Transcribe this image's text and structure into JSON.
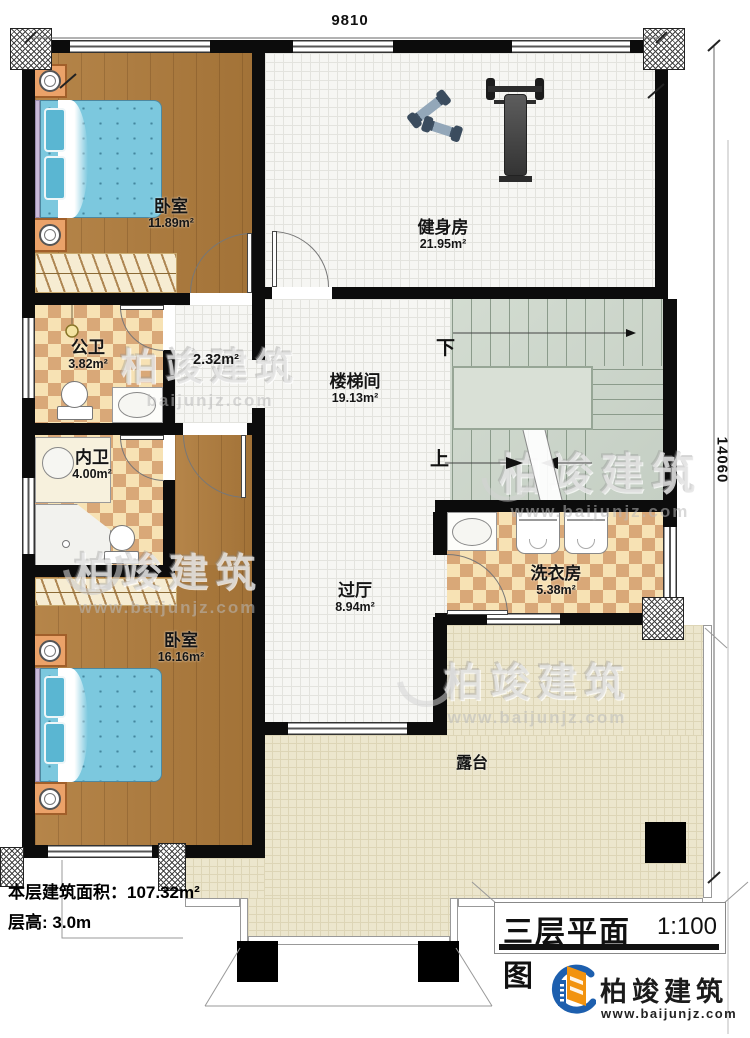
{
  "dimensions": {
    "width_top": "9810",
    "height_right": "14060"
  },
  "rooms": [
    {
      "name": "卧室",
      "area": "11.89m²"
    },
    {
      "name": "健身房",
      "area": "21.95m²"
    },
    {
      "name": "公卫",
      "area": "3.82m²"
    },
    {
      "name": "",
      "area": "2.32m²"
    },
    {
      "name": "楼梯间",
      "area": "19.13m²"
    },
    {
      "name": "内卫",
      "area": "4.00m²"
    },
    {
      "name": "过厅",
      "area": "8.94m²"
    },
    {
      "name": "洗衣房",
      "area": "5.38m²"
    },
    {
      "name": "卧室",
      "area": "16.16m²"
    },
    {
      "name": "露台",
      "area": ""
    }
  ],
  "stairs": {
    "down_label": "下",
    "up_label": "上"
  },
  "info": {
    "area_label": "本层建筑面积：",
    "area_value": "107.32m²",
    "height_label": "层高: ",
    "height_value": "3.0m"
  },
  "title_block": {
    "title": "三层平面图",
    "scale": "1:100"
  },
  "brand": {
    "name": "柏竣建筑",
    "website": "www.baijunjz.com"
  },
  "watermark": {
    "name": "柏竣建筑",
    "site": "www.baijunjz.com",
    "site_short": "baijunjz.com"
  },
  "colors": {
    "wall": "#0c0c0c",
    "wood": "#b07c3c",
    "checker": "#d9a878",
    "stair": "#ccd6cb",
    "terrace": "#ece6cd",
    "brand_blue": "#1d5fae",
    "brand_orange": "#f2930f"
  }
}
